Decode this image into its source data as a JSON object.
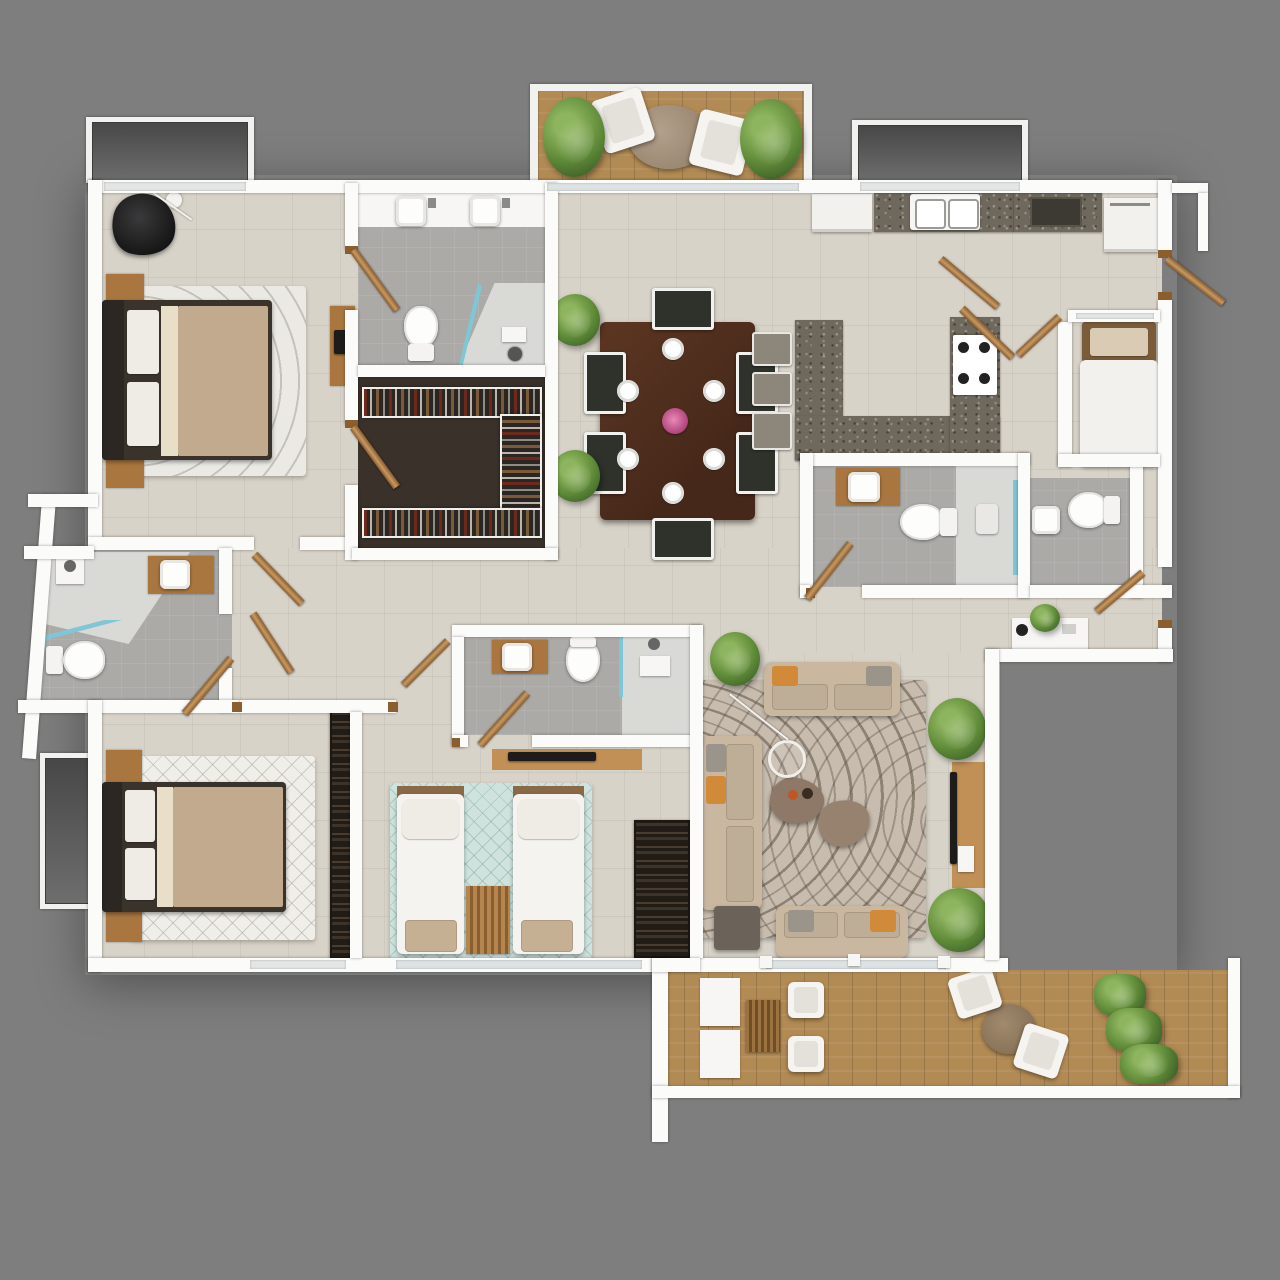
{
  "meta": {
    "title": "3D apartment floor plan - top-down render",
    "view": "top-down",
    "visible_text": "none",
    "style": "photorealistic 3D floor plan on grey background"
  },
  "palette": {
    "bg": "#7e7e7e",
    "wall": "#fbfbfa",
    "floor": "#d8d3c8",
    "bathfloor": "#abaaa7",
    "closet": "#3a312a",
    "granite": "#6f685c",
    "deck": "#b28a54",
    "wood": "#a9763f",
    "teal": "#7fc6d6",
    "sofa": "#c9b7a0",
    "duvet": "#c2aa8e",
    "accentpillow": "#d08a3a",
    "plantgreen": "#5f8a38"
  },
  "rooms": [
    {
      "name": "master bedroom",
      "furniture": [
        "double bed",
        "two nightstands",
        "lounge chair",
        "floor lamp",
        "desk",
        "area rug"
      ]
    },
    {
      "name": "master bathroom",
      "furniture": [
        "double vanity sinks",
        "toilet",
        "corner shower"
      ]
    },
    {
      "name": "walk-in closet",
      "furniture": [
        "U-shaped wardrobe with hanging clothes"
      ]
    },
    {
      "name": "dining area",
      "furniture": [
        "dining table",
        "six chairs",
        "six place settings",
        "flower centerpiece"
      ]
    },
    {
      "name": "kitchen",
      "furniture": [
        "double sink counter",
        "fridge",
        "wall counter",
        "dishwasher",
        "U-shaped island",
        "gas cooktop",
        "three bar stools"
      ]
    },
    {
      "name": "maid room",
      "furniture": [
        "single bed"
      ]
    },
    {
      "name": "hall bathroom",
      "furniture": [
        "vanity sink",
        "toilet",
        "shower"
      ]
    },
    {
      "name": "maid bathroom",
      "furniture": [
        "sink",
        "toilet"
      ]
    },
    {
      "name": "guest bathroom",
      "furniture": [
        "shower",
        "vanity sink",
        "toilet"
      ]
    },
    {
      "name": "kids bathroom",
      "furniture": [
        "vanity sink",
        "toilet",
        "shower"
      ]
    },
    {
      "name": "second bedroom",
      "furniture": [
        "double bed",
        "two nightstands",
        "wardrobe",
        "area rug"
      ]
    },
    {
      "name": "kids bedroom",
      "furniture": [
        "two single beds",
        "bench cushions",
        "slat mat",
        "wardrobe",
        "TV console",
        "area rug"
      ]
    },
    {
      "name": "living room",
      "furniture": [
        "three sofas",
        "two coffee tables",
        "side table",
        "TV console",
        "pendant lamp",
        "wavy rug"
      ]
    },
    {
      "name": "hallway",
      "furniture": [
        "potted plants",
        "console table"
      ]
    },
    {
      "name": "top balcony",
      "furniture": [
        "round table",
        "two chairs",
        "two planters",
        "wood deck"
      ]
    },
    {
      "name": "bottom terrace",
      "furniture": [
        "storage bench",
        "rattan table",
        "two stools",
        "round table",
        "two chairs",
        "planter hedge",
        "wood deck"
      ]
    }
  ],
  "counts": {
    "bedrooms": 4,
    "bathrooms": 5,
    "balconies": 2,
    "doors": 13
  }
}
